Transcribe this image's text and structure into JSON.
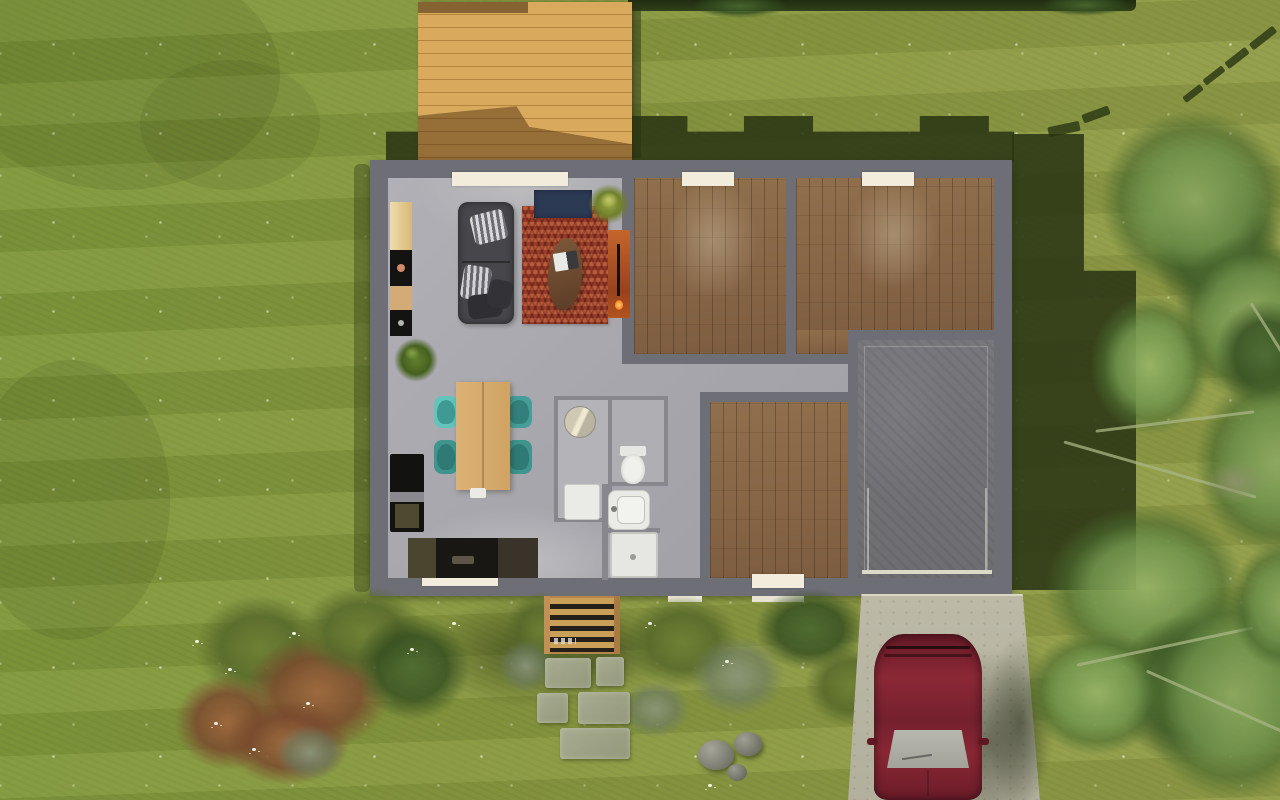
{
  "scene": {
    "type": "aerial-3d-home-plan-render",
    "view": "top-down",
    "labels": {
      "lawn": "Lawn",
      "house": "Single-storey house, top-down cutaway",
      "deck": "Wooden terrace deck",
      "living": "Open-plan living room",
      "dining": "Dining area",
      "kitchen": "Kitchen",
      "bedroom1": "Bedroom 1 (parquet floor)",
      "bedroom2": "Bedroom 2 (parquet floor)",
      "bedroom3": "Bedroom 3 (parquet floor)",
      "bathroom": "Bathroom and WC",
      "hallway": "Hallway",
      "garage": "Garage",
      "garage_door": "Garage door",
      "driveway": "Concrete driveway",
      "car": "Dark red car parked on driveway",
      "steps": "Wooden entrance steps",
      "stepping_stones": "Stepping stone path",
      "rocks": "Garden boulders",
      "bushes": "Flowering shrubs with white blossoms",
      "trees": "Large garden trees",
      "sofa": "Dark grey sofa with cushions",
      "rug": "Red chevron rug",
      "throw": "Navy blue throw",
      "coffee_table": "Oval wooden coffee table",
      "magazine": "Magazine on coffee table",
      "fireplace": "Orange fireplace stove",
      "plant_window": "Potted plant near window",
      "plant_floor": "Potted floor plant",
      "dining_table": "Wooden dining table",
      "dining_chair": "Teal dining chair",
      "kitchen_column": "Kitchen tall units",
      "fridge": "Black fridge unit",
      "counter": "Dark kitchen worktop",
      "mirror": "Round mirror table",
      "washer": "Washing machine",
      "toilet": "Toilet",
      "sink": "Washbasin",
      "shower": "Shower tray",
      "window": "Window sill",
      "shadow": "Cast shadow"
    },
    "counts": {
      "dining_chairs": 4,
      "stepping_stones": 5,
      "windows_top_wall": 3,
      "windows_bottom_wall": 2,
      "wood_floor_rooms": 3,
      "boulders": 3
    },
    "palette": {
      "grass": "#87973f",
      "grass_shadow": "#2b3614",
      "wall_gray": "#6e6e76",
      "interior_floor": "#a8a8ae",
      "parquet": "#8a6845",
      "deck_wood": "#d9aa5d",
      "garage_floor": "#737378",
      "driveway": "#b7b5a2",
      "rug_red": "#b14a30",
      "throw_navy": "#2d3a54",
      "sofa_gray": "#46464b",
      "dining_wood": "#d6ac6e",
      "chair_teal": "#4aa8a0",
      "car_red": "#7d2130",
      "window_sill": "#f1ecdb",
      "fireplace_orange": "#c4662c",
      "cabinet_tan": "#e8d29c",
      "appliance_black": "#151311",
      "fixture_white": "#eaeae6",
      "stone": "#9ba083",
      "tree_green": "#6c8f49"
    }
  }
}
